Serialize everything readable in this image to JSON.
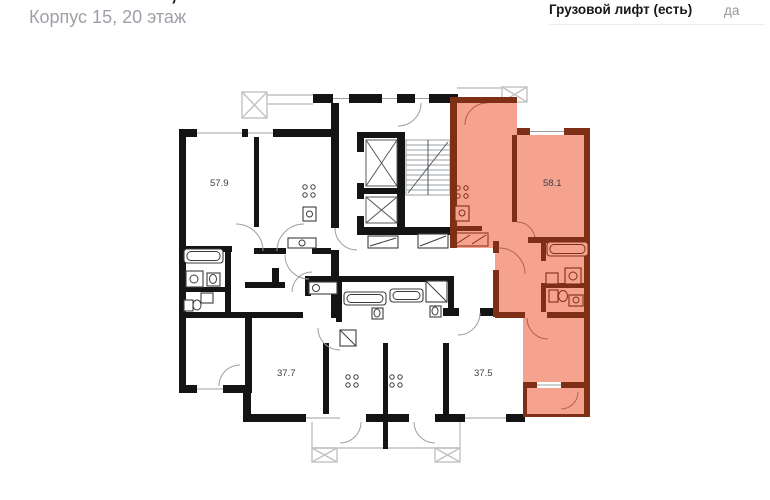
{
  "header": {
    "title": "2-комнатная, 58.1 м²",
    "subtitle": "Корпус 15, 20 этаж",
    "spec_label": "Грузовой лифт (есть)",
    "spec_value": "да"
  },
  "plan": {
    "apartments": [
      {
        "area_label": "57.9",
        "highlighted": false
      },
      {
        "area_label": "58.1",
        "highlighted": true
      },
      {
        "area_label": "37.7",
        "highlighted": false
      },
      {
        "area_label": "37.5",
        "highlighted": false
      }
    ],
    "colors": {
      "highlight_fill": "#F5A28F",
      "highlight_wall": "#7E2F16",
      "wall": "#141414",
      "balcony_line": "#BFC2C4"
    }
  }
}
